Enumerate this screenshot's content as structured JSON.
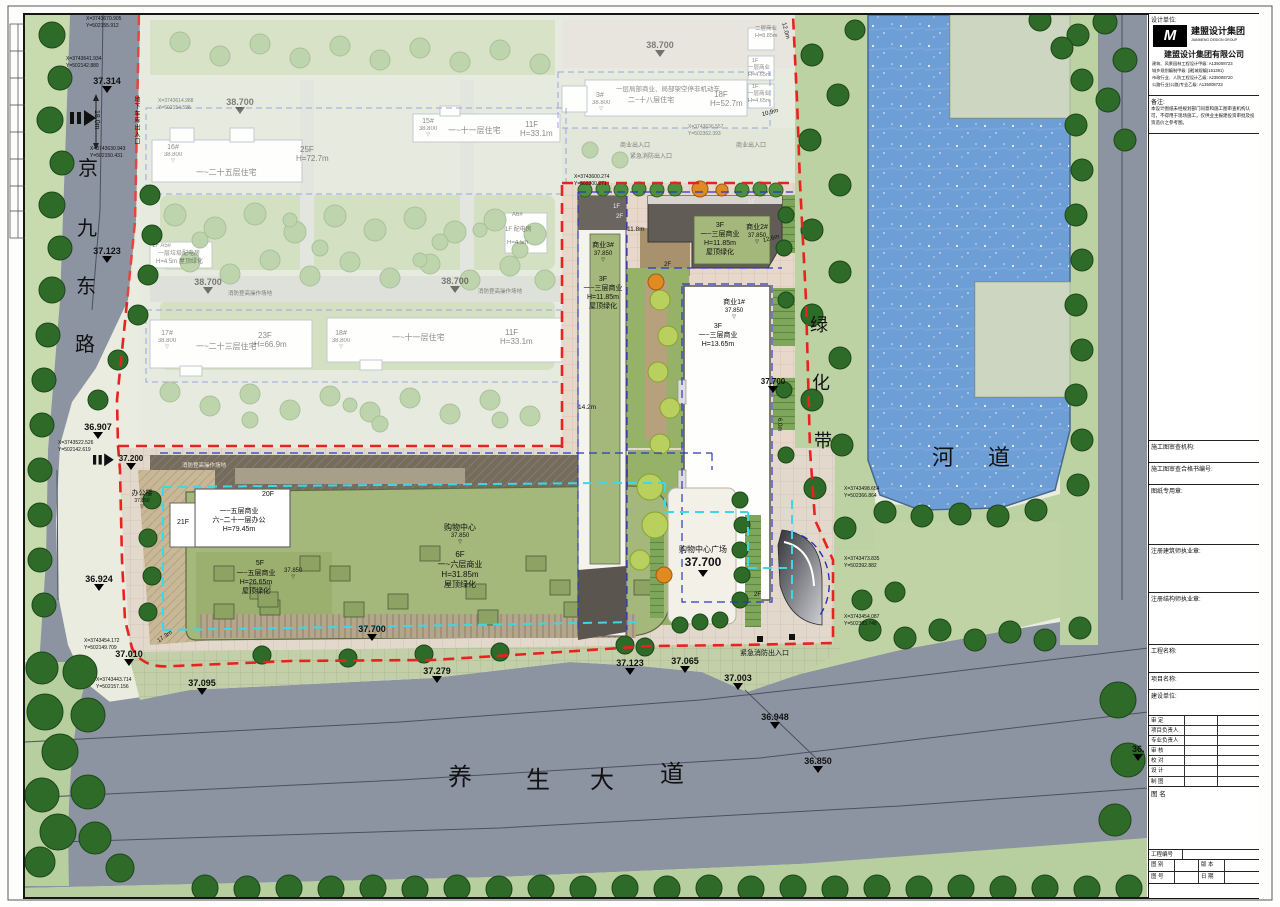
{
  "roads": {
    "jy": [
      "京",
      "九",
      "东",
      "路"
    ],
    "ys": [
      "养",
      "生",
      "大",
      "道"
    ],
    "gb": [
      "绿",
      "化",
      "带"
    ],
    "hd": [
      "河",
      "道"
    ],
    "garage": "地下车库出入口",
    "clip36": "36."
  },
  "el": {
    "e37314": "37.314",
    "e37123": "37.123",
    "e36907": "36.907",
    "e37200": "37.200",
    "e36924": "36.924",
    "e37010": "37.010",
    "e37095": "37.095",
    "e37279": "37.279",
    "e37700": "37.700",
    "e37065": "37.065",
    "e37003": "37.003",
    "e36948": "36.948",
    "e36850": "36.850",
    "e38700": "38.700",
    "e38800": "38.800",
    "v37850": "37.850"
  },
  "bld": {
    "sy3": {
      "no": "商业3#",
      "fl": "3F",
      "use": "一~三层商业",
      "h": "H=11.85m",
      "roof": "屋顶绿化"
    },
    "sy2": {
      "no": "商业2#",
      "fl": "3F",
      "use": "一~三层商业",
      "h": "H=11.85m",
      "roof": "屋顶绿化"
    },
    "sy1": {
      "no": "商业1#",
      "fl": "3F",
      "use": "一~三层商业",
      "h": "H=13.65m"
    },
    "office": {
      "no": "办公楼",
      "f20": "20F",
      "f21": "21F",
      "use1": "一~五层商业",
      "use2": "六~二十一层办公",
      "h": "H=79.45m"
    },
    "m5": {
      "fl": "5F",
      "use": "一~五层商业",
      "h": "H=26.65m",
      "roof": "屋顶绿化"
    },
    "mall": {
      "no": "购物中心",
      "fl": "6F",
      "use": "一~六层商业",
      "h": "H=31.85m",
      "roof": "屋顶绿化"
    },
    "plaza": {
      "no": "购物中心广场"
    },
    "r16": {
      "no": "16#",
      "use": "一~二十五层住宅",
      "fl": "25F",
      "h": "H=72.7m"
    },
    "r15": {
      "no": "15#",
      "use": "一~十一层住宅",
      "fl": "11F",
      "h": "H=33.1m"
    },
    "r17": {
      "no": "17#",
      "use": "一~二十三层住宅",
      "fl": "23F",
      "h": "H=66.9m"
    },
    "r18": {
      "no": "18#",
      "use": "一~十一层住宅",
      "fl": "11F",
      "h": "H=33.1m"
    },
    "r3": {
      "no": "3#",
      "use1": "一层局部商业、局部架空停非机动车",
      "use2": "二~十八层住宅",
      "fl": "18F",
      "h": "H=52.7m"
    },
    "shop1": {
      "fl": "1F",
      "use": "一层商业",
      "h": "H=4.65m"
    },
    "shop2": {
      "use": "二层商业",
      "h": "H=8.85m"
    },
    "a6": {
      "no": "A6#",
      "use": "1F 配电房",
      "h": "H=4.5m"
    },
    "a5": {
      "no": "1F A5#",
      "use": "一层垃圾配电房",
      "h": "H=4.5m 屋顶绿化"
    },
    "f1": "1F",
    "f2": "2F"
  },
  "ent": {
    "fire": "紧急消防出入口",
    "biz": "商业出入口",
    "ops": "消防登高操作场地"
  },
  "dim": {
    "w18": "18.0m",
    "d120": "12.0m",
    "d109": "10.9m",
    "d118": "11.8m",
    "d126": "12.6m",
    "d142": "14.2m",
    "d173": "17.3m",
    "d60": "6.0m"
  },
  "co": {
    "c1": {
      "x": "X=3743670.905",
      "y": "Y=502155.912"
    },
    "c2": {
      "x": "X=3743641.934",
      "y": "Y=502142.889"
    },
    "c3": {
      "x": "X=3743630.943",
      "y": "Y=502150.431"
    },
    "c4": {
      "x": "X=3743614.988",
      "y": "Y=502154.598"
    },
    "c5": {
      "x": "X=3743522.526",
      "y": "Y=502142.619"
    },
    "c6": {
      "x": "X=3743454.172",
      "y": "Y=502149.709"
    },
    "c7": {
      "x": "X=3743443.714",
      "y": "Y=502157.156"
    },
    "c8": {
      "x": "X=3743636.557",
      "y": "Y=502362.393"
    },
    "c9": {
      "x": "X=3743600.274",
      "y": "Y=502300.271"
    },
    "c10": {
      "x": "X=3743498.654",
      "y": "Y=502366.864"
    },
    "c11": {
      "x": "X=3743473.835",
      "y": "Y=502392.882"
    },
    "c12": {
      "x": "X=3743454.087",
      "y": "Y=502393.748"
    }
  },
  "tb": {
    "design_unit": "设计单位:",
    "logo_m": "M",
    "logo_cn": "建盟设计集团",
    "logo_en": "JIANMENG DESIGN GROUP",
    "company": "建盟设计集团有限公司",
    "certs": [
      "建筑、风景园林工程设计甲级: A135008723",
      "城乡规划编制甲级: [建]城规编(161391)",
      "市政行业、人防工程设计乙级: A235008720",
      "公路行业(公路)专业乙级: A135008723"
    ],
    "notes_label": "备注:",
    "notes": "本设计图纸未经规划部门同意和施工图审查机构认可，不得用于现场施工，仅供业主报建投资审批及投资造价之参考图。",
    "f_review": "施工图审查机构:",
    "f_review_no": "施工图审查合格书编号:",
    "f_seal": "图纸专用章:",
    "f_arch": "注册建筑师执业章:",
    "f_struct": "注册结构师执业章:",
    "f_proj": "工程名称:",
    "f_item": "项目名称:",
    "f_client": "建设单位:",
    "sign_rows": [
      "审  定",
      "项目负责人",
      "专业负责人",
      "审  核",
      "校  对",
      "设  计",
      "制  图"
    ],
    "f_dwg_name": "图  名",
    "f_proj_no": "工程编号",
    "f_type": "图  别",
    "f_ver": "版  本",
    "f_no": "图  号",
    "f_date": "日  期"
  }
}
